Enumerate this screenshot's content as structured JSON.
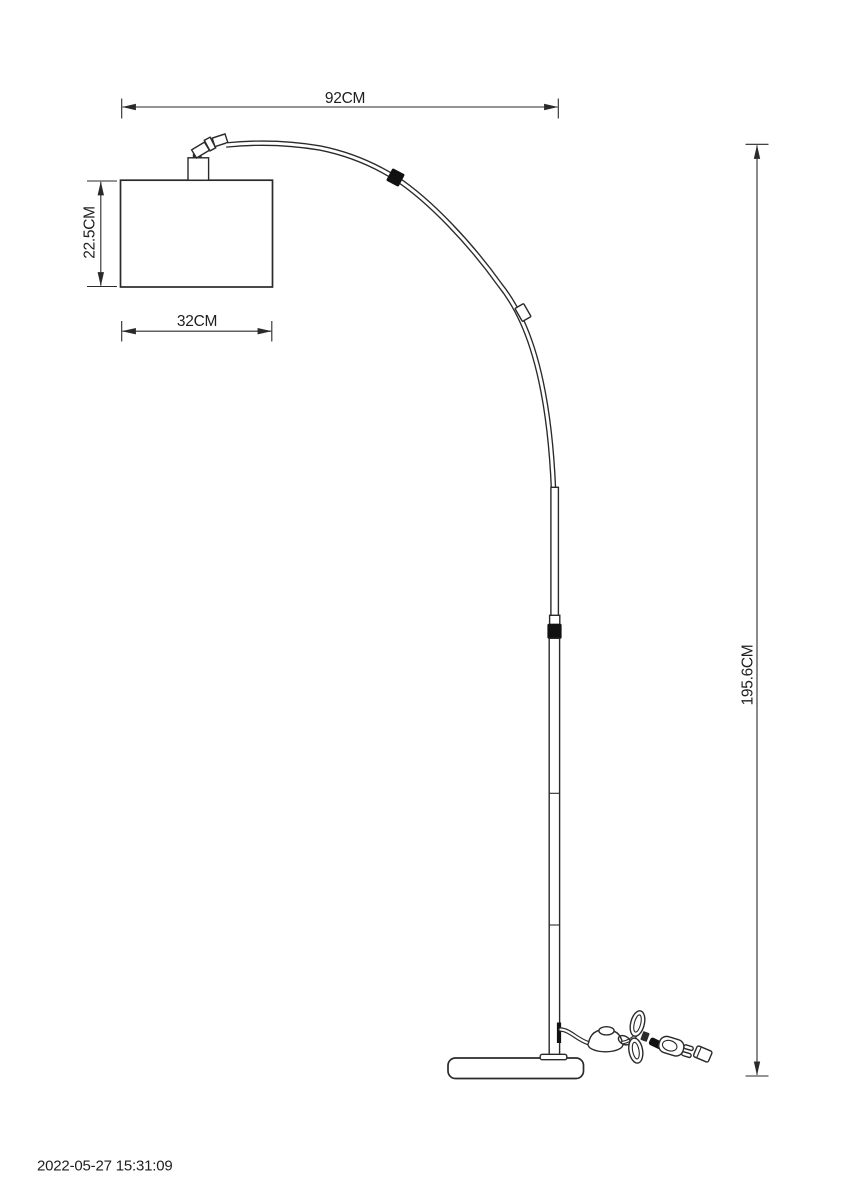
{
  "drawing": {
    "type": "technical-line-drawing",
    "subject": "arc floor lamp with rectangular shade, bent arm, telescopic pole, round base, foot switch and power plug",
    "colors": {
      "line": "#2a2a2a",
      "text": "#1f1f1f",
      "solid_black": "#111111",
      "background": "#ffffff"
    },
    "dimensions": {
      "reach": {
        "label": "92CM"
      },
      "shade_height": {
        "label": "22.5CM"
      },
      "shade_width": {
        "label": "32CM"
      },
      "total_height": {
        "label": "195.6CM"
      }
    }
  },
  "footer": {
    "timestamp": "2022-05-27 15:31:09"
  }
}
